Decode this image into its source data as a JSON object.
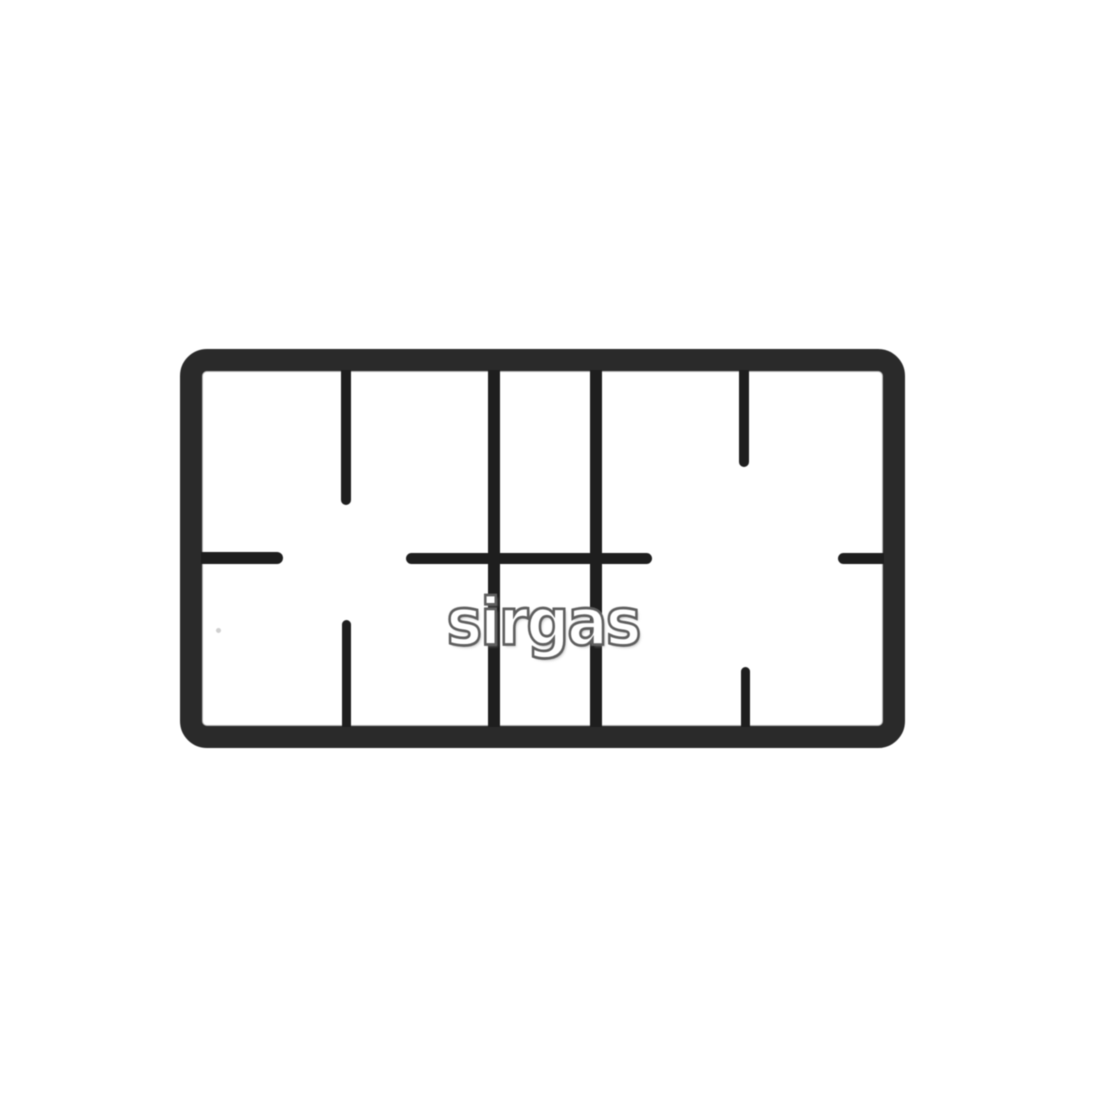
{
  "photo": {
    "watermark": "sirgas"
  },
  "colors": {
    "background": "#ffffff",
    "grate_frame": "#2a2a2a",
    "grate_bars": "#1e1e1e",
    "watermark_fill": "#ffffff",
    "watermark_outline": "#5e5e5e"
  }
}
